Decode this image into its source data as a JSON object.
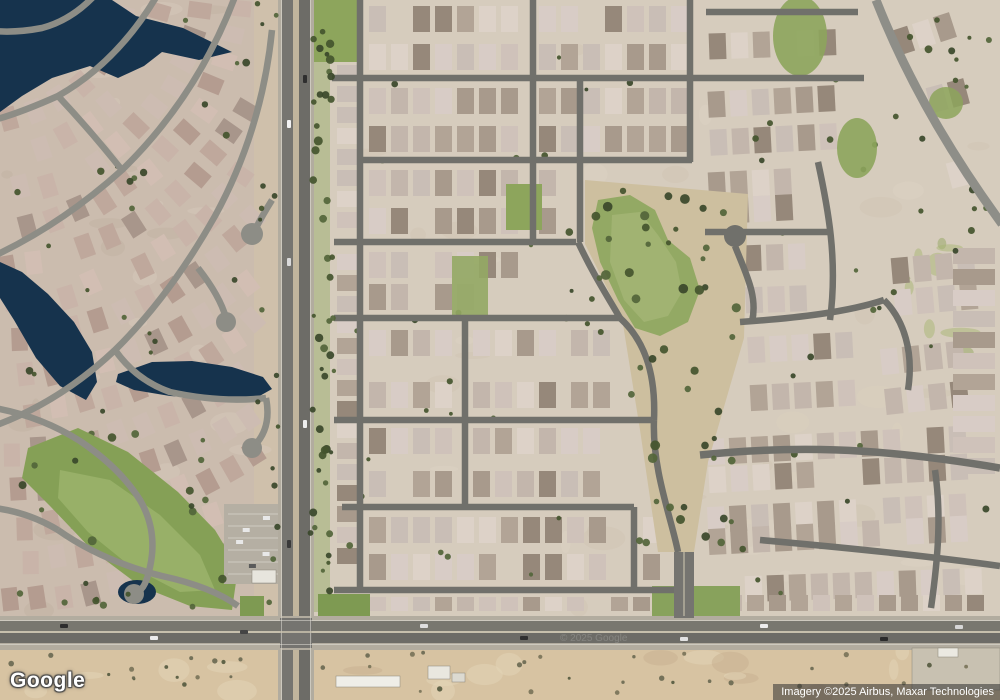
{
  "logo": {
    "text": "Google"
  },
  "attribution": {
    "text": "Imagery ©2025 Airbus, Maxar Technologies",
    "watermark": "© 2025 Google"
  },
  "map": {
    "seed": 11,
    "palette_right": [
      "#cfc2ba",
      "#d8ccc6",
      "#c3b6ac",
      "#b2a496",
      "#ddd2c8",
      "#a89a8c",
      "#c9beb6",
      "#96887a"
    ],
    "palette_left": [
      "#c9b4a9",
      "#bfa89c",
      "#d2beb3",
      "#b49c90",
      "#cdbcb2",
      "#a8968b"
    ],
    "tree_colors": {
      "dark": [
        "#44552e",
        "#39482a",
        "#53653a"
      ],
      "shrub": [
        "#6b6a52",
        "#7a7459",
        "#565b40"
      ]
    },
    "water_color": "#16334d",
    "regions": [
      [
        0,
        0,
        282,
        700,
        "#cbbcae"
      ],
      [
        282,
        0,
        718,
        700,
        "#d6ccbd"
      ],
      [
        254,
        0,
        28,
        620,
        "#cfc0ab"
      ],
      [
        0,
        648,
        1000,
        52,
        "#d7c3a2"
      ]
    ],
    "mottles": [
      [
        0,
        0,
        254,
        612,
        26,
        "#c2b1a2",
        "#d7cabc",
        0.45
      ],
      [
        332,
        0,
        660,
        612,
        30,
        "#cfc3b1",
        "#ded4c5",
        0.4
      ],
      [
        0,
        650,
        1000,
        46,
        18,
        "#c7b08f",
        "#e4d5b8",
        0.5
      ],
      [
        884,
        234,
        112,
        130,
        9,
        "#93a562",
        "#a7b574",
        0.5
      ],
      [
        700,
        380,
        290,
        170,
        8,
        "#cdc2ae",
        "#ddd2bf",
        0.4
      ]
    ],
    "left_houses": {
      "cx": -20,
      "cy": -30,
      "r0": 150,
      "r1": 660,
      "step": 37,
      "a0": -0.06,
      "a1": 1.6,
      "gap": 27,
      "w": 16,
      "h": 23,
      "xmin": 6,
      "xmax": 254,
      "ymin": 4,
      "ymax": 608
    },
    "house_blocks": [
      [
        366,
        2,
        158,
        72,
        0,
        0
      ],
      [
        536,
        2,
        160,
        72,
        0,
        0
      ],
      [
        706,
        18,
        152,
        52,
        -2,
        0
      ],
      [
        366,
        84,
        158,
        72,
        0,
        0
      ],
      [
        536,
        84,
        160,
        72,
        0,
        0
      ],
      [
        706,
        84,
        150,
        72,
        -3,
        0
      ],
      [
        366,
        166,
        160,
        72,
        0,
        0
      ],
      [
        536,
        166,
        42,
        72,
        0,
        0
      ],
      [
        706,
        166,
        102,
        60,
        -3,
        0
      ],
      [
        366,
        248,
        158,
        66,
        0,
        0
      ],
      [
        366,
        326,
        92,
        86,
        0,
        0
      ],
      [
        470,
        326,
        94,
        86,
        0,
        0
      ],
      [
        568,
        326,
        56,
        86,
        0,
        0
      ],
      [
        366,
        424,
        92,
        77,
        0,
        0
      ],
      [
        470,
        424,
        153,
        77,
        0,
        0
      ],
      [
        366,
        513,
        256,
        71,
        0,
        0
      ],
      [
        640,
        513,
        34,
        71,
        0,
        0
      ],
      [
        366,
        594,
        300,
        20,
        0,
        0
      ],
      [
        334,
        20,
        26,
        566,
        0,
        2
      ],
      [
        742,
        240,
        84,
        76,
        -2,
        0
      ],
      [
        746,
        330,
        128,
        82,
        -3,
        0
      ],
      [
        880,
        340,
        104,
        74,
        -6,
        0
      ],
      [
        705,
        428,
        278,
        62,
        -3,
        0
      ],
      [
        705,
        496,
        276,
        56,
        -3,
        0
      ],
      [
        742,
        560,
        244,
        50,
        -2,
        0
      ],
      [
        890,
        6,
        86,
        50,
        -18,
        0
      ],
      [
        935,
        75,
        64,
        112,
        -15,
        0
      ],
      [
        890,
        250,
        100,
        66,
        -5,
        0
      ],
      [
        950,
        245,
        48,
        236,
        0,
        2
      ],
      [
        700,
        592,
        288,
        22,
        0,
        0
      ]
    ],
    "open_areas": [
      {
        "pts": "585,180 748,194 744,338 708,462 694,552 658,552 640,430 622,318 585,244",
        "f": "#cdbf9f"
      }
    ],
    "greens": [
      {
        "t": "rect",
        "x": 308,
        "y": 0,
        "w": 52,
        "h": 62,
        "f": "#8da55c"
      },
      {
        "t": "rect",
        "x": 308,
        "y": 62,
        "w": 22,
        "h": 550,
        "f": "#9aae6e",
        "o": 0.5
      },
      {
        "t": "rect",
        "x": 506,
        "y": 184,
        "w": 36,
        "h": 46,
        "f": "#8da55c"
      },
      {
        "t": "rect",
        "x": 452,
        "y": 256,
        "w": 36,
        "h": 60,
        "f": "#93a964",
        "o": 0.9
      },
      {
        "t": "poly",
        "pts": "598,200 630,195 655,210 668,240 690,258 700,290 688,322 660,336 635,328 618,300 600,262 592,228",
        "f": "#93a964"
      },
      {
        "t": "poly",
        "pts": "612,215 640,212 658,235 676,262 682,292 668,316 644,322 624,300 610,262",
        "f": "#a6b878",
        "o": 0.7
      },
      {
        "t": "ell",
        "x": 800,
        "y": 36,
        "rx": 27,
        "ry": 40,
        "f": "#8da55c",
        "o": 0.9
      },
      {
        "t": "ell",
        "x": 857,
        "y": 148,
        "rx": 20,
        "ry": 30,
        "f": "#8da55c",
        "o": 0.9
      },
      {
        "t": "ell",
        "x": 946,
        "y": 103,
        "rx": 17,
        "ry": 16,
        "f": "#8da55c",
        "o": 0.85
      },
      {
        "t": "poly",
        "pts": "28,448 78,428 128,452 178,492 215,530 238,568 232,610 190,606 140,586 92,550 50,506 22,478",
        "f": "#85a056"
      },
      {
        "t": "poly",
        "pts": "60,470 110,480 160,515 200,555 215,590 180,592 130,566 88,532 58,498",
        "f": "#9cb46d",
        "o": 0.8
      },
      {
        "t": "rect",
        "x": 240,
        "y": 596,
        "w": 24,
        "h": 22,
        "f": "#7e9a52"
      },
      {
        "t": "rect",
        "x": 318,
        "y": 594,
        "w": 52,
        "h": 24,
        "f": "#7e9a52"
      },
      {
        "t": "rect",
        "x": 652,
        "y": 586,
        "w": 88,
        "h": 32,
        "f": "#88a25c"
      }
    ],
    "water": [
      {
        "t": "poly",
        "pts": "0,0 112,0 136,16 183,28 232,52 199,60 162,52 144,66 118,78 90,66 52,78 22,96 0,112"
      },
      {
        "t": "poly",
        "pts": "0,262 22,272 48,294 74,322 92,352 97,382 86,400 60,386 36,358 14,320 0,298"
      },
      {
        "t": "poly",
        "pts": "118,374 152,362 192,361 232,367 263,377 272,389 256,398 214,399 170,396 134,390 116,382"
      },
      {
        "t": "ell",
        "x": 137,
        "y": 592,
        "rx": 19,
        "ry": 12
      }
    ],
    "parking": {
      "x": 224,
      "y": 504,
      "w": 58,
      "h": 80,
      "f": "#b5afa3",
      "stripe": "#e6e4dc"
    },
    "streets": [
      {
        "d": "M332 78 H864",
        "w": 6.5,
        "c": "#70706b"
      },
      {
        "d": "M706 12 H858",
        "w": 6.5,
        "c": "#70706b"
      },
      {
        "d": "M360 160 H692",
        "w": 6.5,
        "c": "#70706b"
      },
      {
        "d": "M334 242 H576",
        "w": 6.5,
        "c": "#70706b"
      },
      {
        "d": "M334 318 H620",
        "w": 6.5,
        "c": "#70706b"
      },
      {
        "d": "M334 420 H652",
        "w": 6.5,
        "c": "#70706b"
      },
      {
        "d": "M342 507 H634",
        "w": 6.5,
        "c": "#70706b"
      },
      {
        "d": "M334 590 H688",
        "w": 6.5,
        "c": "#70706b"
      },
      {
        "d": "M360 -5 V590",
        "w": 6.5,
        "c": "#70706b"
      },
      {
        "d": "M533 -5 V242",
        "w": 6.5,
        "c": "#70706b"
      },
      {
        "d": "M580 78 V242",
        "w": 6.5,
        "c": "#70706b"
      },
      {
        "d": "M465 318 V507",
        "w": 6.5,
        "c": "#70706b"
      },
      {
        "d": "M634 507 V590",
        "w": 6.5,
        "c": "#70706b"
      },
      {
        "d": "M690 -5 V162",
        "w": 6.5,
        "c": "#70706b"
      },
      {
        "d": "M578 242 C592 272 606 294 620 318",
        "w": 6.5,
        "c": "#70706b"
      },
      {
        "d": "M620 318 C644 340 656 372 654 420",
        "w": 6.5,
        "c": "#70706b"
      },
      {
        "d": "M654 420 C652 470 672 520 678 552",
        "w": 6.5,
        "c": "#70706b"
      },
      {
        "d": "M705 232 H828",
        "w": 6.5,
        "c": "#70706b"
      },
      {
        "d": "M818 162 C828 208 838 260 830 320",
        "w": 6.5,
        "c": "#70706b"
      },
      {
        "d": "M740 322 C798 318 848 312 884 300",
        "w": 6.5,
        "c": "#70706b"
      },
      {
        "d": "M735 246 C746 274 758 296 752 322",
        "w": 6.5,
        "c": "#70706b"
      },
      {
        "d": "M884 300 C904 320 914 352 908 390",
        "w": 6.5,
        "c": "#70706b"
      },
      {
        "d": "M700 455 C788 446 872 446 1000 468",
        "w": 7.5,
        "c": "#70706b"
      },
      {
        "d": "M760 540 C850 548 928 556 1000 566",
        "w": 6.5,
        "c": "#70706b"
      },
      {
        "d": "M935 470 C941 512 939 552 931 608",
        "w": 6.5,
        "c": "#70706b"
      },
      {
        "d": "M876 0 Q920 112 1002 224",
        "w": 9,
        "c": "#8e8e88"
      },
      {
        "d": "M158 -6 Q118 62 58 96 Q20 113 -6 120",
        "w": 6.5,
        "c": "#8d8d86"
      },
      {
        "d": "M236 -6 Q198 96 122 170 Q62 224 -6 256",
        "w": 6.5,
        "c": "#8d8d86"
      },
      {
        "d": "M272 30 Q262 130 215 216 Q170 296 115 350 Q60 402 -6 426",
        "w": 6.5,
        "c": "#8d8d86"
      },
      {
        "d": "M198 268 Q220 296 226 318",
        "w": 6.5,
        "c": "#8d8d86"
      },
      {
        "d": "M272 200 Q262 216 256 228",
        "w": 6.5,
        "c": "#8d8d86"
      },
      {
        "d": "M115 350 Q136 380 170 392 Q220 403 266 398",
        "w": 6.5,
        "c": "#8d8d86"
      },
      {
        "d": "M-6 408 Q40 416 80 441 Q120 468 140 500 Q158 531 150 567 Q145 592 135 592",
        "w": 6.5,
        "c": "#8d8d86"
      },
      {
        "d": "M-6 508 Q28 512 58 530",
        "w": 6.5,
        "c": "#8d8d86"
      },
      {
        "d": "M266 398 Q272 428 254 446",
        "w": 6.5,
        "c": "#8d8d86"
      },
      {
        "d": "M58 530 Q102 561 162 576 Q212 587 238 606",
        "w": 6.5,
        "c": "#8d8d86"
      },
      {
        "d": "M96 -6 Q72 20 42 28 Q16 33 -6 31",
        "w": 6.5,
        "c": "#8d8d86"
      },
      {
        "d": "M58 96 Q90 130 122 170",
        "w": 6.5,
        "c": "#8d8d86"
      }
    ],
    "bulbs": [
      [
        252,
        234,
        11,
        "#8d8d86"
      ],
      [
        226,
        322,
        10,
        "#8d8d86"
      ],
      [
        252,
        448,
        10,
        "#8d8d86"
      ],
      [
        134,
        594,
        10,
        "#8d8d86"
      ],
      [
        735,
        236,
        11,
        "#70706b"
      ]
    ],
    "art_rects": [
      [
        278,
        0,
        36,
        700,
        "#b2ac9f"
      ],
      [
        282,
        0,
        11,
        700,
        "#767570"
      ],
      [
        293,
        0,
        6,
        700,
        "#c1b59d"
      ],
      [
        299,
        0,
        11,
        700,
        "#6d6c67"
      ],
      [
        0,
        616,
        1000,
        34,
        "#b2ac9f"
      ],
      [
        0,
        621,
        1000,
        10,
        "#78776f"
      ],
      [
        0,
        633,
        1000,
        10,
        "#6d6c67"
      ],
      [
        280,
        618,
        32,
        30,
        "#757470"
      ],
      [
        674,
        552,
        20,
        66,
        "#757470"
      ]
    ],
    "art_lines": [
      [
        281.5,
        0,
        281.5,
        700,
        1,
        "#e9e7de",
        0.5
      ],
      [
        310.5,
        0,
        310.5,
        700,
        1,
        "#e9e7de",
        0.5
      ],
      [
        0,
        620.5,
        1000,
        620.5,
        1,
        "#e9e7de",
        0.5
      ],
      [
        0,
        644.5,
        1000,
        644.5,
        1,
        "#e9e7de",
        0.5
      ],
      [
        0,
        632,
        1000,
        632,
        2,
        "#cfc7b2",
        0.75
      ],
      [
        684,
        552,
        684,
        616,
        1.5,
        "#cfc7b2",
        0.7
      ]
    ],
    "buildings": [
      [
        912,
        648,
        88,
        42,
        "#c8c1b1"
      ],
      [
        336,
        676,
        64,
        11,
        "#efeee8"
      ],
      [
        428,
        666,
        22,
        13,
        "#e9e7df"
      ],
      [
        452,
        673,
        13,
        9,
        "#dcdad1"
      ],
      [
        938,
        648,
        20,
        9,
        "#ebe9e1"
      ],
      [
        252,
        570,
        24,
        13,
        "#e7e5dd"
      ]
    ],
    "trees": [
      [
        310,
        2,
        24,
        610,
        46,
        2,
        4.5,
        "dark",
        2
      ],
      [
        556,
        190,
        186,
        144,
        26,
        2.5,
        5,
        "dark",
        2
      ],
      [
        624,
        334,
        112,
        218,
        24,
        2.5,
        5,
        "dark",
        2
      ],
      [
        6,
        6,
        246,
        596,
        40,
        2,
        4,
        "dark",
        1
      ],
      [
        340,
        12,
        350,
        586,
        26,
        1.8,
        3.4,
        "dark",
        1
      ],
      [
        702,
        12,
        292,
        596,
        30,
        1.8,
        3.6,
        "dark",
        1
      ],
      [
        4,
        652,
        990,
        44,
        42,
        1.4,
        2.8,
        "shrub",
        2
      ],
      [
        34,
        436,
        198,
        172,
        14,
        2.5,
        4.5,
        "dark",
        2
      ],
      [
        256,
        2,
        26,
        606,
        16,
        1.8,
        3.2,
        "dark",
        2
      ],
      [
        868,
        36,
        128,
        180,
        12,
        2,
        4,
        "dark",
        1
      ]
    ],
    "cars": [
      [
        287,
        120,
        4,
        8,
        "#f2f2f2"
      ],
      [
        303,
        75,
        4,
        8,
        "#2e2e2e"
      ],
      [
        287,
        258,
        4,
        8,
        "#dadada"
      ],
      [
        303,
        420,
        4,
        8,
        "#ededed"
      ],
      [
        287,
        540,
        4,
        8,
        "#3a3a3a"
      ],
      [
        60,
        624,
        8,
        4,
        "#2d2d2d"
      ],
      [
        150,
        636,
        8,
        4,
        "#ebebeb"
      ],
      [
        420,
        624,
        8,
        4,
        "#dedede"
      ],
      [
        520,
        636,
        8,
        4,
        "#303030"
      ],
      [
        760,
        624,
        8,
        4,
        "#ededed"
      ],
      [
        880,
        637,
        8,
        4,
        "#2b2b2b"
      ],
      [
        955,
        625,
        8,
        4,
        "#d7d7d7"
      ],
      [
        680,
        637,
        8,
        4,
        "#e2e2e2"
      ],
      [
        240,
        630,
        8,
        4,
        "#444444"
      ]
    ]
  }
}
